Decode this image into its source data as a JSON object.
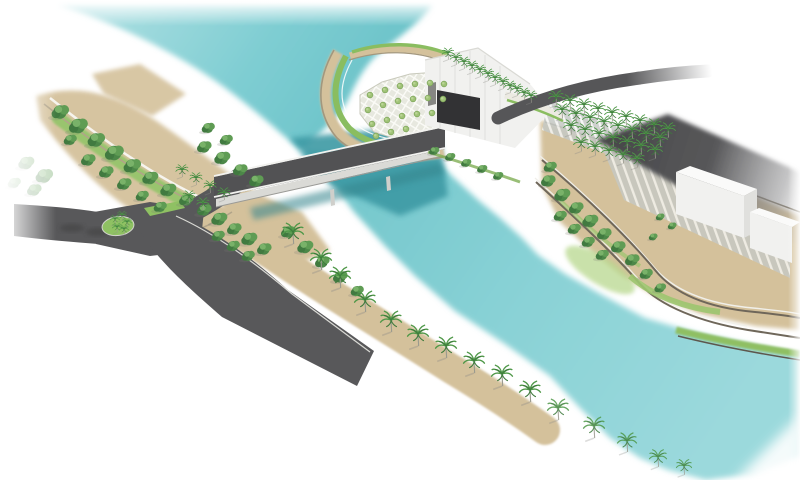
{
  "scene": {
    "kind": "architectural-aerial-render",
    "subject": "bridge-over-turquoise-canal-with-landscaped-promenades"
  },
  "palette": {
    "background": "#ffffff",
    "water": "#7ecdd2",
    "water_light": "#9bd9dc",
    "water_deep": "#3d9aa4",
    "sand": "#d4c19b",
    "sand_light": "#e0d2b0",
    "road": "#58585a",
    "road_dark": "#47474a",
    "bridge_deck": "#525254",
    "girder": "#dadad6",
    "grass": "#8fc163",
    "grass_light": "#b7d78c",
    "grass_dark": "#6fae4e",
    "tree": "#4c8748",
    "tree_light": "#79b269",
    "olive": "#9fc276",
    "palm": "#4f9848",
    "trunk": "#9a9a8e",
    "wall_dark": "#6f675a",
    "wall_light": "#a3977d",
    "path_white": "#f6f4ee",
    "curb": "#d9d9d4",
    "building": "#f1f1ef",
    "building_top": "#fafaf9",
    "building_shade": "#e0e0dd",
    "opening": "#323234",
    "stripe_bg": "#c5c9c5",
    "stripe_line": "#f4f5f4",
    "bridge_shadow": "#35858d"
  },
  "instances": [
    {
      "symbol": "sym-palm",
      "layer": "palms-promenade",
      "points": [
        [
          293,
          232,
          1.1
        ],
        [
          321,
          258,
          1.1
        ],
        [
          340,
          276,
          1.1
        ],
        [
          365,
          300,
          1.1
        ],
        [
          391,
          320,
          1.1
        ],
        [
          418,
          334,
          1.1
        ],
        [
          446,
          346,
          1.1
        ],
        [
          474,
          361,
          1.1
        ],
        [
          502,
          374,
          1.1
        ],
        [
          530,
          390,
          1.1
        ]
      ]
    },
    {
      "symbol": "sym-palm",
      "layer": "palms-beach",
      "points": [
        [
          558,
          408,
          1.1
        ],
        [
          594,
          426,
          1.1
        ],
        [
          627,
          441,
          1.0
        ],
        [
          658,
          457,
          0.9
        ],
        [
          684,
          466,
          0.8
        ]
      ]
    },
    {
      "symbol": "sym-palm",
      "layer": "palms-roof",
      "points": [
        [
          448,
          53,
          0.62
        ],
        [
          456,
          58,
          0.62
        ],
        [
          464,
          62,
          0.62
        ],
        [
          472,
          66,
          0.62
        ],
        [
          480,
          70,
          0.62
        ],
        [
          488,
          74,
          0.62
        ],
        [
          495,
          78,
          0.62
        ],
        [
          503,
          82,
          0.62
        ],
        [
          510,
          86,
          0.62
        ],
        [
          517,
          89,
          0.62
        ],
        [
          524,
          93,
          0.62
        ],
        [
          531,
          96,
          0.62
        ]
      ]
    },
    {
      "symbol": "sym-palm",
      "layer": "palms-grid",
      "points": [
        [
          556,
          97,
          0.78
        ],
        [
          570,
          101,
          0.78
        ],
        [
          584,
          105,
          0.78
        ],
        [
          598,
          109,
          0.78
        ],
        [
          612,
          113,
          0.78
        ],
        [
          626,
          117,
          0.78
        ],
        [
          640,
          121,
          0.78
        ],
        [
          654,
          125,
          0.78
        ],
        [
          668,
          129,
          0.78
        ],
        [
          562,
          110,
          0.78
        ],
        [
          576,
          114,
          0.78
        ],
        [
          590,
          118,
          0.78
        ],
        [
          604,
          122,
          0.78
        ],
        [
          618,
          126,
          0.78
        ],
        [
          632,
          130,
          0.78
        ],
        [
          646,
          134,
          0.78
        ],
        [
          660,
          138,
          0.78
        ],
        [
          571,
          126,
          0.78
        ],
        [
          585,
          130,
          0.78
        ],
        [
          599,
          134,
          0.78
        ],
        [
          613,
          138,
          0.78
        ],
        [
          627,
          142,
          0.78
        ],
        [
          641,
          146,
          0.78
        ],
        [
          655,
          150,
          0.78
        ],
        [
          581,
          143,
          0.78
        ],
        [
          595,
          147,
          0.78
        ],
        [
          609,
          151,
          0.78
        ],
        [
          623,
          155,
          0.78
        ],
        [
          637,
          159,
          0.78
        ]
      ]
    },
    {
      "symbol": "sym-palm",
      "layer": "palms-roundabout",
      "points": [
        [
          115,
          219,
          0.5
        ],
        [
          122,
          215,
          0.5
        ],
        [
          127,
          222,
          0.5
        ],
        [
          117,
          227,
          0.5
        ],
        [
          124,
          229,
          0.5
        ]
      ]
    },
    {
      "symbol": "sym-palm",
      "layer": "palms-park",
      "points": [
        [
          182,
          170,
          0.65
        ],
        [
          196,
          178,
          0.65
        ],
        [
          210,
          186,
          0.65
        ],
        [
          224,
          193,
          0.65
        ],
        [
          189,
          196,
          0.65
        ],
        [
          203,
          203,
          0.65
        ]
      ]
    },
    {
      "symbol": "sym-tree",
      "layer": "trees-left-park",
      "points": [
        [
          60,
          112,
          1.2
        ],
        [
          78,
          126,
          1.3
        ],
        [
          96,
          140,
          1.2
        ],
        [
          114,
          153,
          1.3
        ],
        [
          132,
          166,
          1.2
        ],
        [
          150,
          178,
          1.1
        ],
        [
          168,
          190,
          1.1
        ],
        [
          186,
          200,
          1.0
        ],
        [
          204,
          147,
          1.0
        ],
        [
          222,
          158,
          1.1
        ],
        [
          240,
          170,
          1.0
        ],
        [
          256,
          181,
          1.0
        ],
        [
          208,
          128,
          0.9
        ],
        [
          226,
          140,
          0.9
        ],
        [
          88,
          160,
          1.0
        ],
        [
          106,
          172,
          1.0
        ],
        [
          124,
          184,
          1.0
        ],
        [
          142,
          196,
          0.9
        ],
        [
          70,
          140,
          0.9
        ],
        [
          160,
          207,
          0.9
        ]
      ]
    },
    {
      "symbol": "sym-tree",
      "layer": "trees-wedge",
      "points": [
        [
          204,
          210,
          1.0
        ],
        [
          219,
          219,
          1.1
        ],
        [
          234,
          229,
          1.0
        ],
        [
          249,
          239,
          1.1
        ],
        [
          264,
          249,
          1.0
        ],
        [
          218,
          236,
          0.9
        ],
        [
          233,
          246,
          0.9
        ],
        [
          248,
          256,
          0.9
        ],
        [
          288,
          232,
          1.0
        ],
        [
          305,
          247,
          1.1
        ],
        [
          322,
          262,
          1.0
        ],
        [
          340,
          277,
          1.0
        ],
        [
          357,
          291,
          0.9
        ]
      ]
    },
    {
      "symbol": "sym-tree",
      "layer": "trees-terrace",
      "points": [
        [
          548,
          181,
          1.0
        ],
        [
          562,
          195,
          1.1
        ],
        [
          576,
          208,
          1.0
        ],
        [
          590,
          221,
          1.1
        ],
        [
          604,
          234,
          1.0
        ],
        [
          618,
          247,
          1.0
        ],
        [
          632,
          260,
          1.0
        ],
        [
          560,
          216,
          0.9
        ],
        [
          574,
          229,
          0.9
        ],
        [
          588,
          242,
          0.9
        ],
        [
          602,
          255,
          0.9
        ],
        [
          646,
          274,
          0.9
        ],
        [
          660,
          288,
          0.8
        ],
        [
          550,
          167,
          0.9
        ],
        [
          660,
          217,
          0.6
        ],
        [
          672,
          226,
          0.6
        ],
        [
          653,
          237,
          0.6
        ],
        [
          434,
          151,
          0.7
        ],
        [
          450,
          157,
          0.7
        ],
        [
          466,
          163,
          0.7
        ],
        [
          482,
          169,
          0.7
        ],
        [
          498,
          176,
          0.7
        ]
      ]
    },
    {
      "symbol": "sym-olive",
      "layer": "trees-mound",
      "points": [
        [
          370,
          95,
          0.9
        ],
        [
          385,
          90,
          0.9
        ],
        [
          400,
          86,
          0.9
        ],
        [
          415,
          84,
          0.9
        ],
        [
          430,
          83,
          0.9
        ],
        [
          444,
          84,
          0.9
        ],
        [
          368,
          110,
          0.9
        ],
        [
          383,
          105,
          0.9
        ],
        [
          398,
          101,
          0.9
        ],
        [
          413,
          99,
          0.9
        ],
        [
          428,
          98,
          0.9
        ],
        [
          443,
          99,
          0.9
        ],
        [
          372,
          124,
          0.9
        ],
        [
          387,
          120,
          0.9
        ],
        [
          402,
          116,
          0.9
        ],
        [
          417,
          114,
          0.9
        ],
        [
          432,
          113,
          0.9
        ],
        [
          376,
          136,
          0.9
        ],
        [
          391,
          132,
          0.9
        ],
        [
          406,
          129,
          0.9
        ]
      ]
    },
    {
      "symbol": "sym-tree",
      "layer": "trees-faded",
      "points": [
        [
          26,
          163,
          1.1
        ],
        [
          44,
          176,
          1.2
        ],
        [
          14,
          183,
          0.9
        ],
        [
          34,
          190,
          1.0
        ]
      ]
    }
  ]
}
